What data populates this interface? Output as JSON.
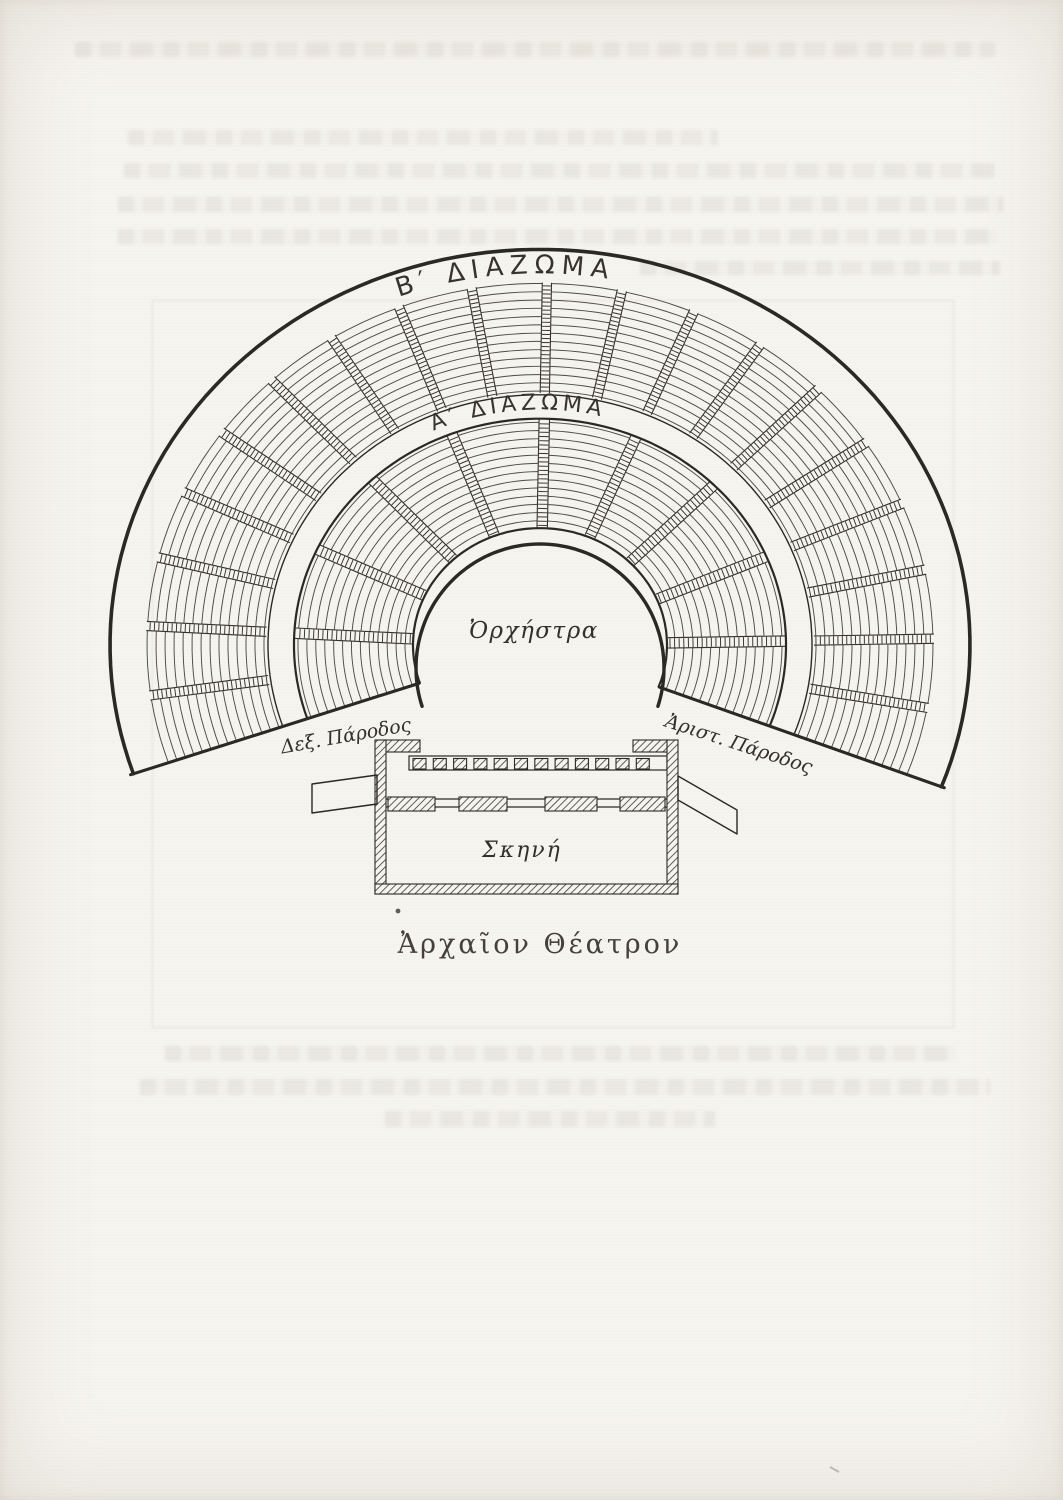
{
  "page": {
    "paper_color": "#f6f4ef",
    "ink_color": "#2b2923"
  },
  "figure": {
    "upper_tier_label": "Β′ ΔΙΑΖΩΜΑ",
    "lower_tier_label": "Α′ ΔΙΑΖΩΜΑ",
    "orchestra_label": "Ὀρχήστρα",
    "stage_label": "Σκηνή",
    "right_parodos_label": "Δεξ. Πάροδος",
    "left_parodos_label": "Ἀριστ. Πάροδος",
    "caption": "Ἀρχαῖον Θέατρον"
  }
}
